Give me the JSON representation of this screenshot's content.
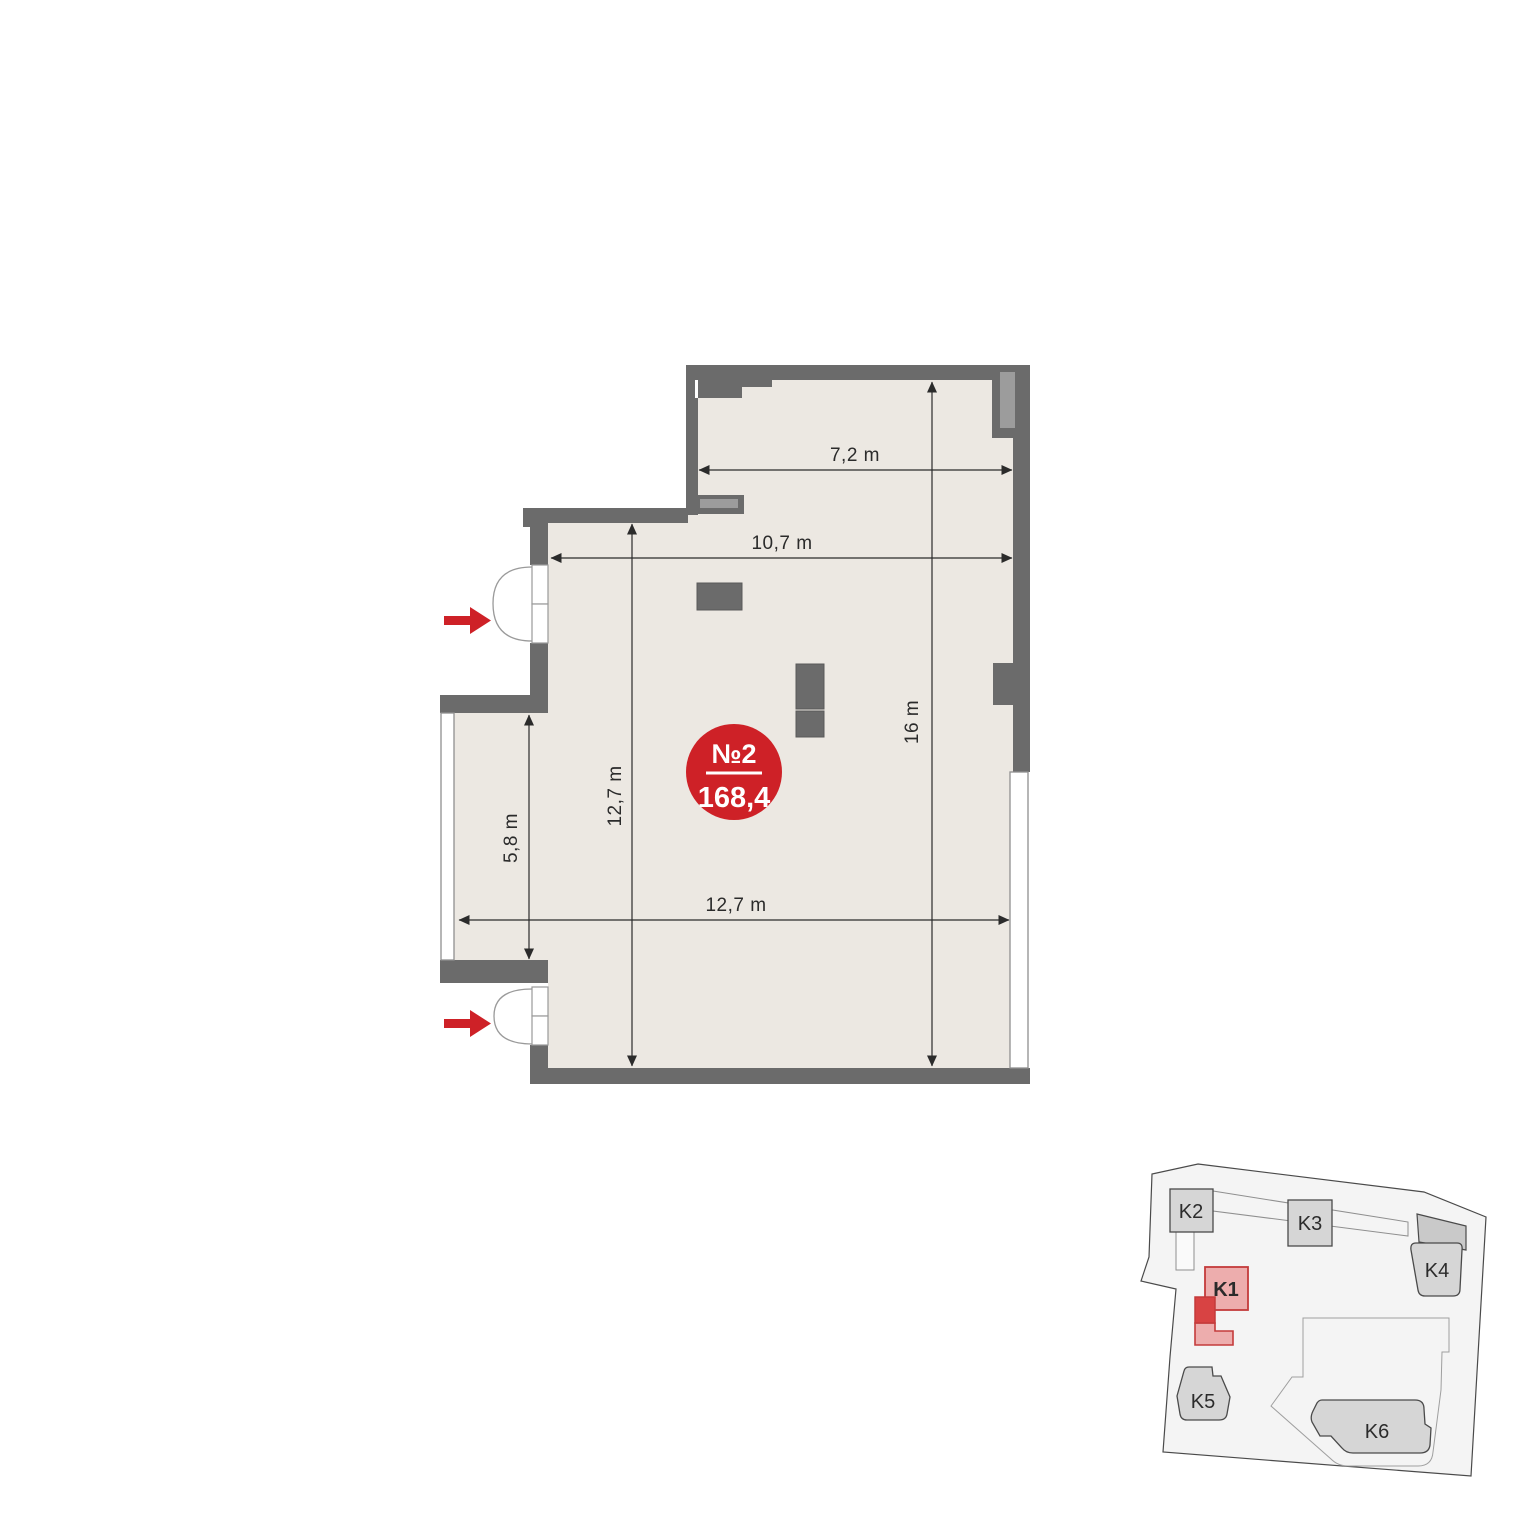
{
  "floor_plan": {
    "badge": {
      "unit_number": "№2",
      "area": "168,4"
    },
    "dims": {
      "top_width": "7,2 m",
      "mid_width": "10,7 m",
      "bottom_width": "12,7 m",
      "room_height": "12,7 m",
      "right_height": "16 m",
      "bay_height": "5,8 m"
    }
  },
  "site_plan": {
    "buildings": [
      {
        "label": "K1",
        "highlighted": true
      },
      {
        "label": "K2",
        "highlighted": false
      },
      {
        "label": "K3",
        "highlighted": false
      },
      {
        "label": "K4",
        "highlighted": false
      },
      {
        "label": "K5",
        "highlighted": false
      },
      {
        "label": "K6",
        "highlighted": false
      }
    ]
  },
  "colors": {
    "accent_red": "#ce2127",
    "wall_gray": "#6b6b6b",
    "floor_beige": "#ece8e2",
    "shaft_gray": "#9c9c9c",
    "site_fill": "#f4f4f4",
    "building_fill": "#d6d6d6",
    "highlight_fill": "#edadad",
    "highlight_dark": "#d84343",
    "highlight_stroke": "#c43b3b"
  }
}
